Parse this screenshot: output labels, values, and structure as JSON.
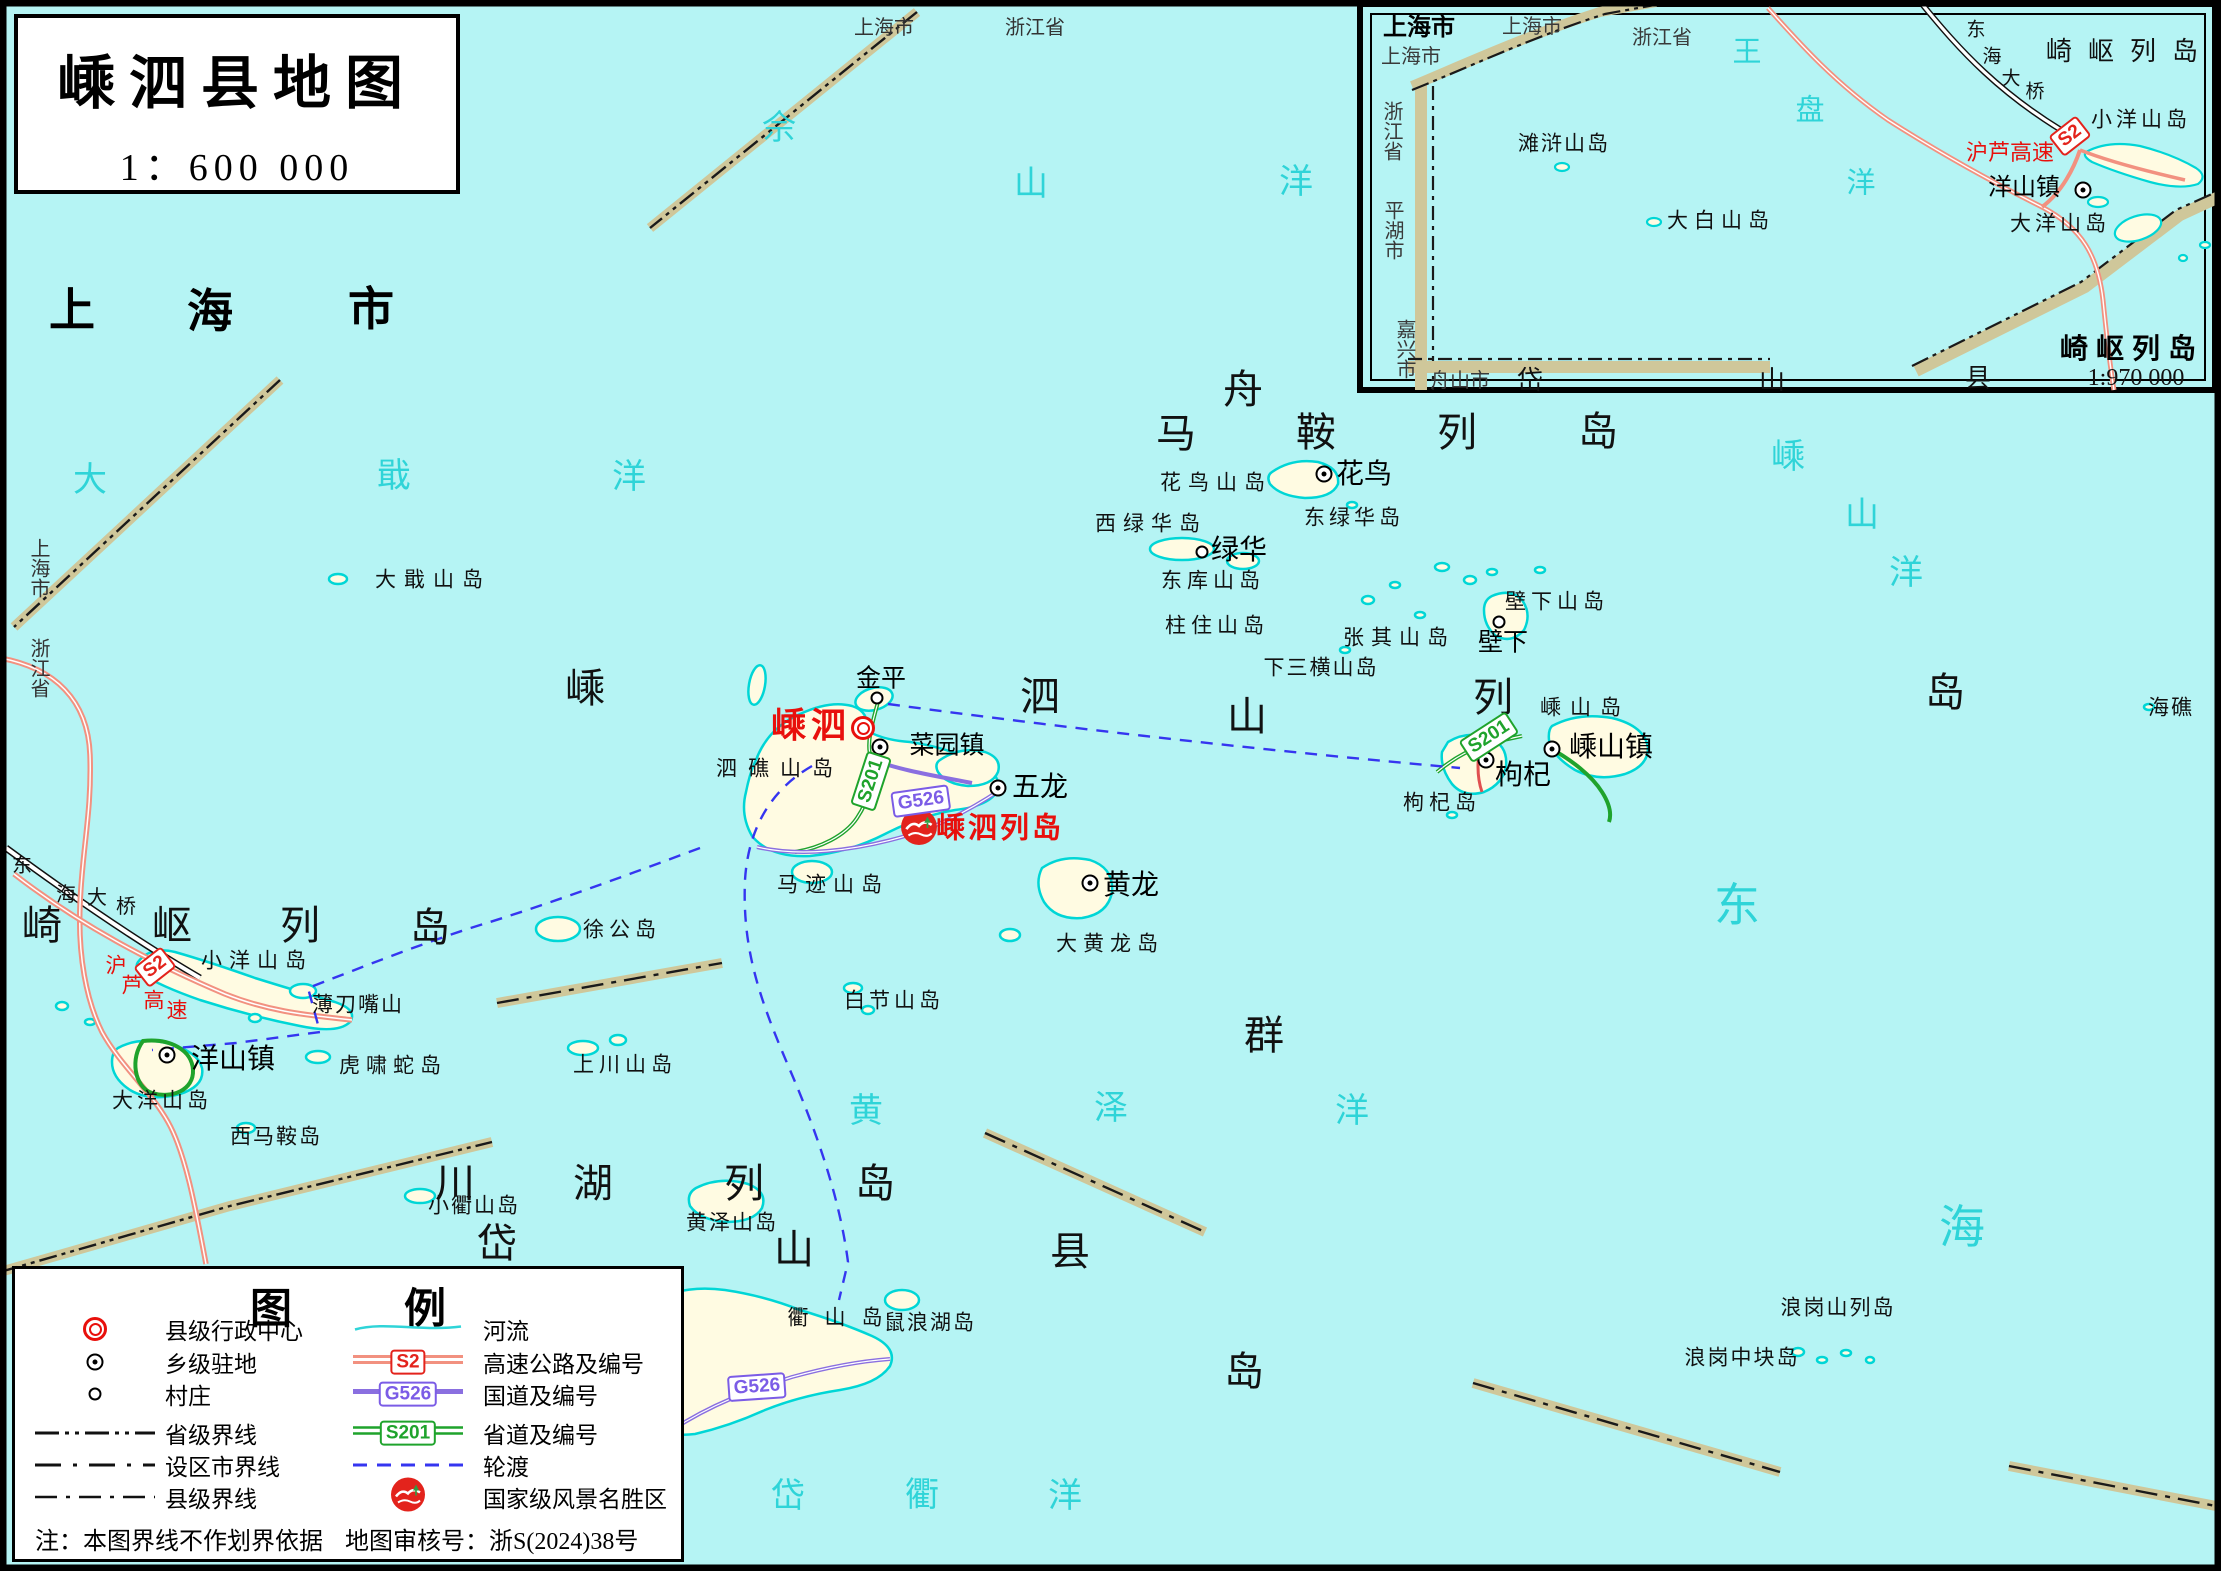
{
  "title_box": {
    "title": "嵊泗县地图",
    "scale": "1：600 000"
  },
  "legend": {
    "title": "图例",
    "left": [
      {
        "label": "县级行政中心"
      },
      {
        "label": "乡级驻地"
      },
      {
        "label": "村庄"
      },
      {
        "label": "省级界线"
      },
      {
        "label": "设区市界线"
      },
      {
        "label": "县级界线"
      }
    ],
    "right": [
      {
        "label": "河流"
      },
      {
        "label": "高速公路及编号",
        "badge": "S2"
      },
      {
        "label": "国道及编号",
        "badge": "G526"
      },
      {
        "label": "省道及编号",
        "badge": "S201"
      },
      {
        "label": "轮渡"
      },
      {
        "label": "国家级风景名胜区"
      }
    ],
    "note": "注：本图界线不作划界依据",
    "approval": "地图审核号：浙S(2024)38号"
  },
  "colors": {
    "sea": "#B5F4F4",
    "island": "#FFFBE2",
    "island_outline": "#00D6D6",
    "expressway": "#F29180",
    "national_road": "#8A6FE0",
    "provincial_road": "#1FA32C",
    "ferry": "#3535F0",
    "boundary_band": "#CFC79A",
    "badge_red": "#E3231C",
    "badge_purple": "#7B5CE6",
    "badge_green": "#1FA32C",
    "red_label": "#E8100C",
    "sea_label": "#2FD4D8"
  },
  "map_labels": [
    {
      "t": "上",
      "x": 72,
      "y": 310,
      "c": "hugeBold"
    },
    {
      "t": "海",
      "x": 210,
      "y": 311,
      "c": "hugeBold"
    },
    {
      "t": "市",
      "x": 371,
      "y": 309,
      "c": "hugeBold"
    },
    {
      "t": "上海市",
      "x": 884,
      "y": 28,
      "c": "admin"
    },
    {
      "t": "浙江省",
      "x": 1035,
      "y": 28,
      "c": "admin"
    },
    {
      "t": "上海市",
      "x": 38,
      "y": 568,
      "c": "admin",
      "v": 1
    },
    {
      "t": "浙江省",
      "x": 38,
      "y": 668,
      "c": "admin",
      "v": 1
    },
    {
      "t": "佘",
      "x": 779,
      "y": 129,
      "c": "sea"
    },
    {
      "t": "山",
      "x": 1031,
      "y": 185,
      "c": "sea"
    },
    {
      "t": "洋",
      "x": 1296,
      "y": 183,
      "c": "sea"
    },
    {
      "t": "大",
      "x": 90,
      "y": 481,
      "c": "sea"
    },
    {
      "t": "戢",
      "x": 394,
      "y": 477,
      "c": "sea"
    },
    {
      "t": "洋",
      "x": 629,
      "y": 478,
      "c": "sea"
    },
    {
      "t": "嵊",
      "x": 1788,
      "y": 458,
      "c": "sea"
    },
    {
      "t": "山",
      "x": 1862,
      "y": 516,
      "c": "sea"
    },
    {
      "t": "洋",
      "x": 1906,
      "y": 574,
      "c": "sea"
    },
    {
      "t": "黄",
      "x": 866,
      "y": 1112,
      "c": "sea"
    },
    {
      "t": "泽",
      "x": 1111,
      "y": 1109,
      "c": "sea"
    },
    {
      "t": "洋",
      "x": 1352,
      "y": 1112,
      "c": "sea"
    },
    {
      "t": "岱",
      "x": 788,
      "y": 1497,
      "c": "sea"
    },
    {
      "t": "衢",
      "x": 922,
      "y": 1496,
      "c": "sea"
    },
    {
      "t": "洋",
      "x": 1065,
      "y": 1497,
      "c": "sea"
    },
    {
      "t": "东",
      "x": 1737,
      "y": 906,
      "c": "seaHuge"
    },
    {
      "t": "海",
      "x": 1962,
      "y": 1228,
      "c": "seaHuge"
    },
    {
      "t": "崎",
      "x": 42,
      "y": 926,
      "c": "huge"
    },
    {
      "t": "岖",
      "x": 172,
      "y": 926,
      "c": "huge"
    },
    {
      "t": "列",
      "x": 300,
      "y": 926,
      "c": "huge"
    },
    {
      "t": "岛",
      "x": 430,
      "y": 928,
      "c": "huge"
    },
    {
      "t": "马",
      "x": 1176,
      "y": 434,
      "c": "huge"
    },
    {
      "t": "鞍",
      "x": 1316,
      "y": 433,
      "c": "huge"
    },
    {
      "t": "列",
      "x": 1457,
      "y": 433,
      "c": "huge"
    },
    {
      "t": "岛",
      "x": 1598,
      "y": 432,
      "c": "huge"
    },
    {
      "t": "嵊",
      "x": 585,
      "y": 689,
      "c": "huge"
    },
    {
      "t": "泗",
      "x": 1040,
      "y": 697,
      "c": "huge"
    },
    {
      "t": "列",
      "x": 1493,
      "y": 698,
      "c": "huge"
    },
    {
      "t": "岛",
      "x": 1945,
      "y": 693,
      "c": "huge"
    },
    {
      "t": "舟",
      "x": 1243,
      "y": 390,
      "c": "huge"
    },
    {
      "t": "山",
      "x": 1247,
      "y": 717,
      "c": "huge"
    },
    {
      "t": "群",
      "x": 1264,
      "y": 1036,
      "c": "huge"
    },
    {
      "t": "岛",
      "x": 1244,
      "y": 1372,
      "c": "huge"
    },
    {
      "t": "川",
      "x": 455,
      "y": 1184,
      "c": "huge"
    },
    {
      "t": "湖",
      "x": 593,
      "y": 1184,
      "c": "huge"
    },
    {
      "t": "列",
      "x": 744,
      "y": 1184,
      "c": "huge"
    },
    {
      "t": "岛",
      "x": 875,
      "y": 1184,
      "c": "huge"
    },
    {
      "t": "岱",
      "x": 497,
      "y": 1244,
      "c": "huge"
    },
    {
      "t": "山",
      "x": 794,
      "y": 1250,
      "c": "huge"
    },
    {
      "t": "县",
      "x": 1070,
      "y": 1252,
      "c": "huge"
    },
    {
      "t": "东",
      "x": 22,
      "y": 866,
      "c": "bridgeLbl"
    },
    {
      "t": "海",
      "x": 66,
      "y": 895,
      "c": "bridgeLbl"
    },
    {
      "t": "大",
      "x": 97,
      "y": 898,
      "c": "bridgeLbl"
    },
    {
      "t": "桥",
      "x": 126,
      "y": 907,
      "c": "bridgeLbl"
    },
    {
      "t": "沪",
      "x": 116,
      "y": 966,
      "c": "roadRed"
    },
    {
      "t": "芦",
      "x": 132,
      "y": 986,
      "c": "roadRed"
    },
    {
      "t": "高",
      "x": 154,
      "y": 1001,
      "c": "roadRed"
    },
    {
      "t": "速",
      "x": 177,
      "y": 1011,
      "c": "roadRed"
    },
    {
      "t": "大戢山岛",
      "x": 433,
      "y": 580,
      "c": "place",
      "ls": 8
    },
    {
      "t": "小洋山岛",
      "x": 257,
      "y": 961,
      "c": "place",
      "ls": 7
    },
    {
      "t": "薄刀嘴山",
      "x": 358,
      "y": 1005,
      "c": "place",
      "ls": 2
    },
    {
      "t": "虎啸蛇岛",
      "x": 393,
      "y": 1066,
      "c": "place",
      "ls": 6
    },
    {
      "t": "大洋山岛",
      "x": 162,
      "y": 1101,
      "c": "place",
      "ls": 4
    },
    {
      "t": "西马鞍岛",
      "x": 276,
      "y": 1137,
      "c": "place",
      "ls": 2
    },
    {
      "t": "徐公岛",
      "x": 622,
      "y": 930,
      "c": "place",
      "ls": 5
    },
    {
      "t": "马迹山岛",
      "x": 833,
      "y": 885,
      "c": "place",
      "ls": 7
    },
    {
      "t": "泗礁山岛",
      "x": 780,
      "y": 769,
      "c": "place",
      "ls": 11
    },
    {
      "t": "白节山岛",
      "x": 894,
      "y": 1001,
      "c": "place",
      "ls": 4
    },
    {
      "t": "上川山岛",
      "x": 625,
      "y": 1065,
      "c": "place",
      "ls": 5
    },
    {
      "t": "大黄龙岛",
      "x": 1110,
      "y": 944,
      "c": "place",
      "ls": 6
    },
    {
      "t": "花鸟山岛",
      "x": 1216,
      "y": 483,
      "c": "place",
      "ls": 7
    },
    {
      "t": "东绿华岛",
      "x": 1354,
      "y": 518,
      "c": "place",
      "ls": 4
    },
    {
      "t": "西绿华岛",
      "x": 1151,
      "y": 524,
      "c": "place",
      "ls": 7
    },
    {
      "t": "东库山岛",
      "x": 1213,
      "y": 581,
      "c": "place",
      "ls": 5
    },
    {
      "t": "柱住山岛",
      "x": 1217,
      "y": 626,
      "c": "place",
      "ls": 5
    },
    {
      "t": "张其山岛",
      "x": 1399,
      "y": 638,
      "c": "place",
      "ls": 7
    },
    {
      "t": "壁下山岛",
      "x": 1557,
      "y": 602,
      "c": "place",
      "ls": 5
    },
    {
      "t": "下三横山岛",
      "x": 1321,
      "y": 668,
      "c": "place",
      "ls": 2
    },
    {
      "t": "嵊山岛",
      "x": 1585,
      "y": 708,
      "c": "place",
      "ls": 9
    },
    {
      "t": "枸杞岛",
      "x": 1442,
      "y": 803,
      "c": "place",
      "ls": 5
    },
    {
      "t": "小衢山岛",
      "x": 474,
      "y": 1206,
      "c": "place",
      "ls": 2
    },
    {
      "t": "黄泽山岛",
      "x": 732,
      "y": 1223,
      "c": "place",
      "ls": 2
    },
    {
      "t": "鼠浪湖岛",
      "x": 930,
      "y": 1323,
      "c": "place",
      "ls": 2
    },
    {
      "t": "衢山岛",
      "x": 843,
      "y": 1318,
      "c": "place",
      "ls": 16
    },
    {
      "t": "浪岗山列岛",
      "x": 1838,
      "y": 1308,
      "c": "place",
      "ls": 2
    },
    {
      "t": "浪岗中块岛",
      "x": 1742,
      "y": 1358,
      "c": "place",
      "ls": 2
    },
    {
      "t": "海礁",
      "x": 2171,
      "y": 708,
      "c": "place",
      "ls": 2
    },
    {
      "t": "金平",
      "x": 881,
      "y": 679,
      "c": "town"
    },
    {
      "t": "菜园镇",
      "x": 947,
      "y": 746,
      "c": "town"
    },
    {
      "t": "五龙",
      "x": 1040,
      "y": 788,
      "c": "townBig"
    },
    {
      "t": "黄龙",
      "x": 1131,
      "y": 886,
      "c": "townBig"
    },
    {
      "t": "洋山镇",
      "x": 233,
      "y": 1060,
      "c": "townBig"
    },
    {
      "t": "绿华",
      "x": 1239,
      "y": 551,
      "c": "townBig"
    },
    {
      "t": "花鸟",
      "x": 1364,
      "y": 475,
      "c": "townBig"
    },
    {
      "t": "壁下",
      "x": 1503,
      "y": 643,
      "c": "town"
    },
    {
      "t": "枸杞",
      "x": 1523,
      "y": 776,
      "c": "townBig"
    },
    {
      "t": "嵊山镇",
      "x": 1611,
      "y": 748,
      "c": "townBig"
    },
    {
      "t": "嵊泗",
      "x": 811,
      "y": 726,
      "c": "redCounty",
      "ls": 5
    },
    {
      "t": "嵊泗列岛",
      "x": 1000,
      "y": 829,
      "c": "redScenic",
      "ls": 3
    },
    {
      "t": "上海市",
      "x": 1419,
      "y": 28,
      "c": "insetAdminBold"
    },
    {
      "t": "上海市",
      "x": 1532,
      "y": 27,
      "c": "insetAdmin"
    },
    {
      "t": "上海市",
      "x": 1411,
      "y": 57,
      "c": "insetAdmin"
    },
    {
      "t": "浙江省",
      "x": 1662,
      "y": 38,
      "c": "insetAdmin"
    },
    {
      "t": "浙江省",
      "x": 1391,
      "y": 131,
      "c": "insetAdmin",
      "v": 1
    },
    {
      "t": "平湖市",
      "x": 1392,
      "y": 230,
      "c": "insetAdmin",
      "v": 1
    },
    {
      "t": "嘉兴市",
      "x": 1404,
      "y": 349,
      "c": "insetAdmin",
      "v": 1
    },
    {
      "t": "舟山市",
      "x": 1460,
      "y": 381,
      "c": "insetAdmin"
    },
    {
      "t": "岱",
      "x": 1530,
      "y": 381,
      "c": "insetBig"
    },
    {
      "t": "山",
      "x": 1772,
      "y": 381,
      "c": "insetBig"
    },
    {
      "t": "县",
      "x": 1978,
      "y": 379,
      "c": "insetBig"
    },
    {
      "t": "崎岖列岛",
      "x": 2130,
      "y": 52,
      "c": "insetBig",
      "ls": 16
    },
    {
      "t": "小洋山岛",
      "x": 2141,
      "y": 120,
      "c": "insetPlace",
      "ls": 4
    },
    {
      "t": "大洋山岛",
      "x": 2060,
      "y": 224,
      "c": "insetPlace",
      "ls": 4
    },
    {
      "t": "大白山岛",
      "x": 1721,
      "y": 221,
      "c": "insetPlace",
      "ls": 6
    },
    {
      "t": "滩浒山岛",
      "x": 1564,
      "y": 144,
      "c": "insetPlace",
      "ls": 2
    },
    {
      "t": "洋山镇",
      "x": 2024,
      "y": 188,
      "c": "insetTown"
    },
    {
      "t": "沪芦高速",
      "x": 2010,
      "y": 153,
      "c": "insetRoadRed"
    },
    {
      "t": "东",
      "x": 1976,
      "y": 30,
      "c": "insetBridge"
    },
    {
      "t": "海",
      "x": 1992,
      "y": 57,
      "c": "insetBridge"
    },
    {
      "t": "大",
      "x": 2011,
      "y": 79,
      "c": "insetBridge"
    },
    {
      "t": "桥",
      "x": 2035,
      "y": 92,
      "c": "insetBridge"
    },
    {
      "t": "王",
      "x": 1747,
      "y": 53,
      "c": "insetSea"
    },
    {
      "t": "盘",
      "x": 1810,
      "y": 111,
      "c": "insetSea"
    },
    {
      "t": "洋",
      "x": 1861,
      "y": 184,
      "c": "insetSea"
    },
    {
      "t": "崎岖列岛",
      "x": 2132,
      "y": 349,
      "c": "insetHeader",
      "ls": 8
    },
    {
      "t": "1:970 000",
      "x": 2136,
      "y": 378,
      "c": "insetScale"
    }
  ],
  "markers": [
    {
      "x": 863,
      "y": 728,
      "k": "county"
    },
    {
      "x": 880,
      "y": 747,
      "k": "town"
    },
    {
      "x": 167,
      "y": 1055,
      "k": "town"
    },
    {
      "x": 1324,
      "y": 474,
      "k": "town"
    },
    {
      "x": 1552,
      "y": 749,
      "k": "town"
    },
    {
      "x": 1486,
      "y": 760,
      "k": "town"
    },
    {
      "x": 998,
      "y": 788,
      "k": "town"
    },
    {
      "x": 1090,
      "y": 883,
      "k": "town"
    },
    {
      "x": 2083,
      "y": 190,
      "k": "town"
    },
    {
      "x": 877,
      "y": 698,
      "k": "village"
    },
    {
      "x": 1202,
      "y": 552,
      "k": "village"
    },
    {
      "x": 1499,
      "y": 622,
      "k": "village"
    }
  ],
  "badges": [
    {
      "t": "S2",
      "x": 155,
      "y": 967,
      "k": "red",
      "rot": -38
    },
    {
      "t": "S2",
      "x": 2070,
      "y": 136,
      "k": "red",
      "rot": -38
    },
    {
      "t": "G526",
      "x": 921,
      "y": 801,
      "k": "purple",
      "rot": -8
    },
    {
      "t": "G526",
      "x": 757,
      "y": 1387,
      "k": "purple",
      "rot": -4
    },
    {
      "t": "S201",
      "x": 871,
      "y": 781,
      "k": "green",
      "rot": -72
    },
    {
      "t": "S201",
      "x": 1489,
      "y": 737,
      "k": "green",
      "rot": -33
    }
  ]
}
